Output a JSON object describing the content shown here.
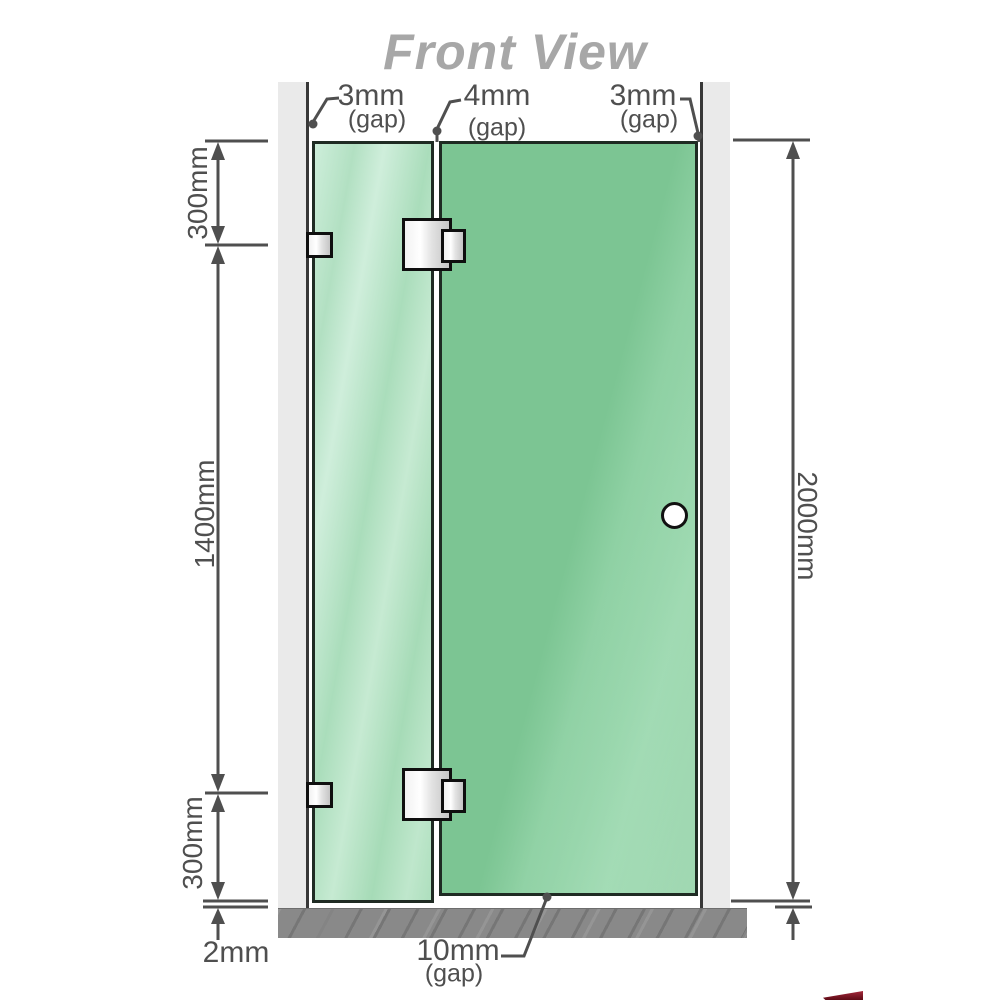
{
  "title": "Front View",
  "gap_labels": {
    "top_left": {
      "value": "3mm",
      "suffix": "(gap)"
    },
    "top_middle": {
      "value": "4mm",
      "suffix": "(gap)"
    },
    "top_right": {
      "value": "3mm",
      "suffix": "(gap)"
    },
    "bottom": {
      "value": "10mm",
      "suffix": "(gap)"
    }
  },
  "dimensions": {
    "left_top": "300mm",
    "left_middle": "1400mm",
    "left_bottom": "300mm",
    "floor_clearance": "2mm",
    "total_height": "2000mm"
  },
  "colors": {
    "door_glass": "#7cc593",
    "fixed_panel_glass": "#b9e4c8",
    "wall": "#eaeaea",
    "floor": "#898989",
    "dimension_lines": "#4f4f4f",
    "title_text": "#a7a7a7",
    "hardware": "#e8e8e8",
    "accent_sliver": "#8c1322"
  }
}
